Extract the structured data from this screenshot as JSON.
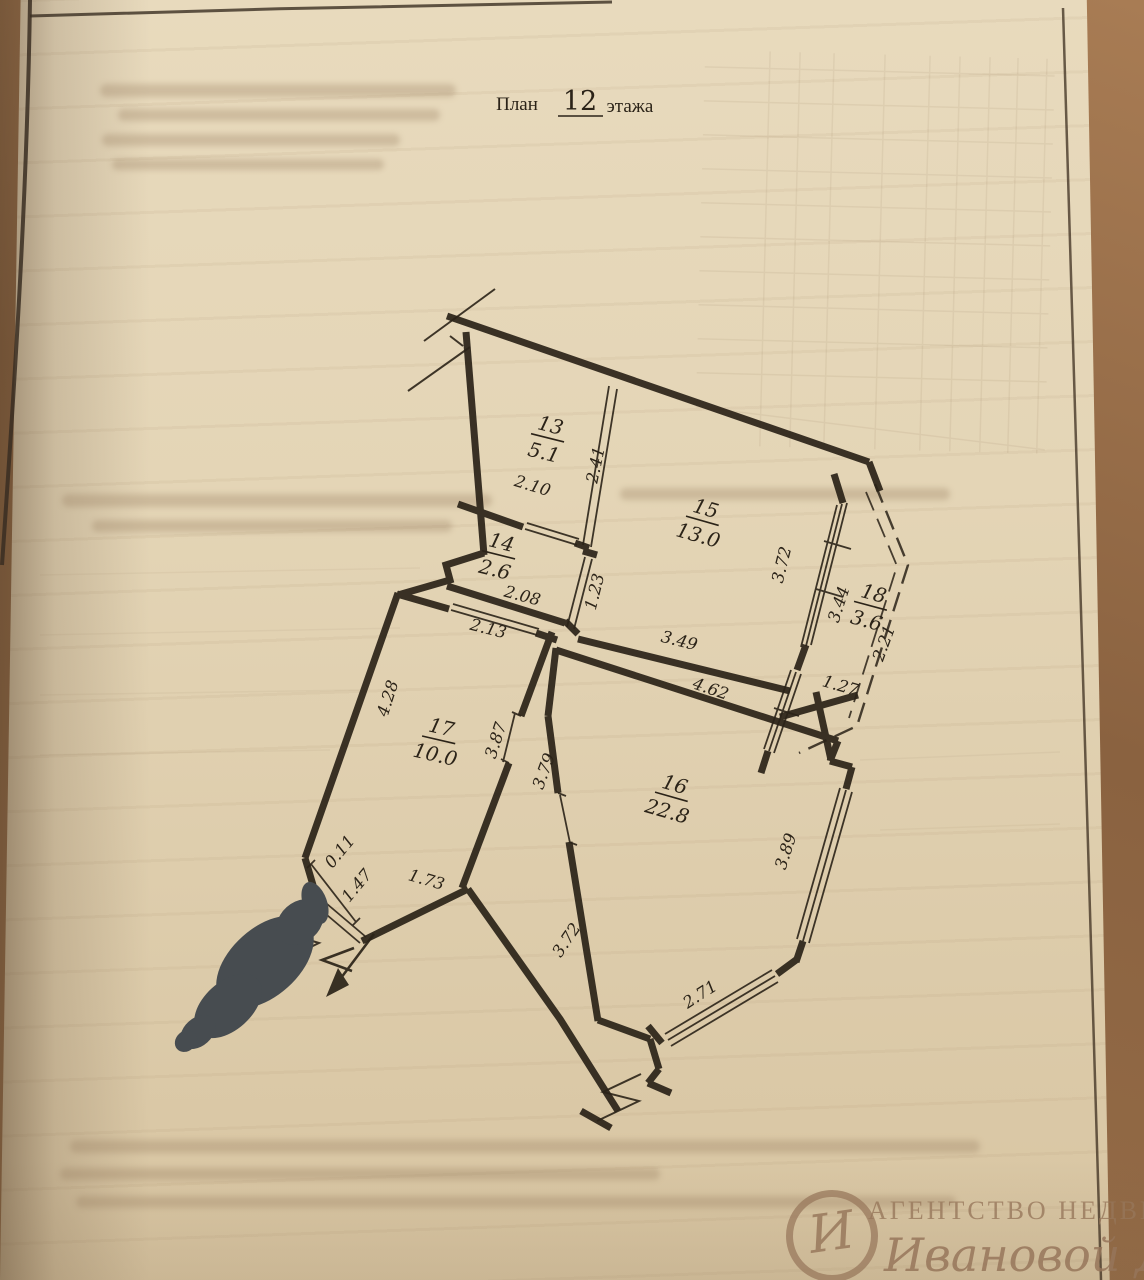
{
  "title": {
    "prefix": "План",
    "floor_number": "12",
    "suffix": "этажа"
  },
  "plan": {
    "rooms": [
      {
        "number": "13",
        "area": "5.1"
      },
      {
        "number": "14",
        "area": "2.6"
      },
      {
        "number": "15",
        "area": "13.0"
      },
      {
        "number": "16",
        "area": "22.8"
      },
      {
        "number": "17",
        "area": "10.0"
      },
      {
        "number": "18",
        "area": "3.6"
      }
    ],
    "dimensions": [
      "2.41",
      "2.10",
      "2.08",
      "1.23",
      "3.49",
      "3.72",
      "3.44",
      "2.21",
      "1.27",
      "4.62",
      "2.13",
      "4.28",
      "3.87",
      "3.79",
      "3.89",
      "0.11",
      "1.47",
      "1.73",
      "3.72",
      "2.71"
    ],
    "ink_color": "#2b2318"
  },
  "watermark": {
    "agency_line": "АГЕНТСТВО НЕДВИЖИМОСТИ",
    "name_line": "Ивановой Дарии",
    "monogram": "И"
  },
  "redaction": {
    "present": true,
    "color": "#474c50"
  }
}
